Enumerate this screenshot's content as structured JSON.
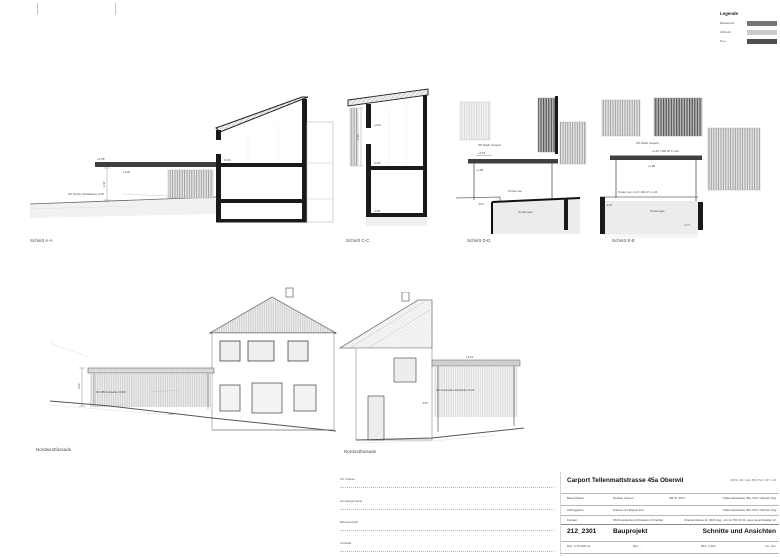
{
  "legend": {
    "title": "Legende",
    "items": [
      {
        "label": "Bestehend",
        "color": "#757575"
      },
      {
        "label": "Abbruch",
        "color": "#cbcbcb"
      },
      {
        "label": "Neu",
        "color": "#4f4f4f"
      }
    ]
  },
  "captions": {
    "schnitt_aa": "Schnitt A-A",
    "schnitt_cc": "Schnitt C-C",
    "schnitt_dd": "Schnitt D-D",
    "schnitt_ee": "Schnitt E-E",
    "nordwest": "Nordwestfassade",
    "nordost": "Nordostfassade"
  },
  "annotations": {
    "aa_lvl_top": "+2.35",
    "aa_lvl_under": "+2.20",
    "aa_dim": "2.37",
    "aa_terrain": "OK Terrain Verkleidung -0.02",
    "aa_zero": "±0.00",
    "cc_lvl1": "+2.69",
    "cc_zero": "±0.00",
    "cc_low": "-0.28",
    "cc_dim": "2.62",
    "dd_roof_label": "OK Dach Carport",
    "dd_lvl": "+2.15",
    "dd_under": "+1.98",
    "dd_terrain_neu": "Terrain neu",
    "dd_terrain_gew": "Terrain gew.",
    "dd_low": "-0.87",
    "ee_roof_label": "OK Dach Carport",
    "ee_lvl": "+2.15 / 492.35 m.ü.M.",
    "ee_under": "+1.96",
    "ee_terrain_neu": "Terrain neu -0.10 / 492.27 m.ü.M.",
    "ee_terrain_gew": "Terrain gew.",
    "ee_low1": "-0.22",
    "ee_low2": "-1.77",
    "nw_dim": "2.60",
    "nw_level": "OK FB Rohdecke ±0.00",
    "nw_low": "-0.87",
    "no_lvl": "+2.15",
    "no_level": "OK Fussboden Rohdecke ±0.00",
    "no_low": "-0.87"
  },
  "titleblock": {
    "project_title": "Carport Tellenmattstrasse 45a Oberwil",
    "parcel_info": "GB Nr. 404 / Geb. 636 / Parz. 427 / 4.M",
    "rows": [
      {
        "label": "Bauvorhaben",
        "value": "Neubau Carport",
        "extra": "GB Nr. 2971",
        "right": "Tellenmattstrasse 45a, 6317 Oberwil, Zug"
      },
      {
        "label": "Auftraggeber",
        "value": "Andrea und Raquel Frei",
        "extra": "",
        "right": "Tellenmattstrasse 45a, 6317 Oberwil, Zug"
      },
      {
        "label": "Kontakt",
        "value": "NM Kussbacher Architekten mb bachat",
        "extra": "",
        "right": "Chamerstrasse 11, 6300 Zug, +41 41 780 01 61, www.nk-architekten.ch"
      }
    ],
    "project_number": "212_2301",
    "phase": "Bauprojekt",
    "sheet_title": "Schnitte und Ansichten",
    "meta": {
      "date": "Dat.: 3.11.2021 lw",
      "rev": "Rev.: -",
      "scale": "Mst.: 1:100",
      "format": "Gr.: A2+"
    }
  },
  "signatures": {
    "items": [
      {
        "label": "Ort / Datum"
      },
      {
        "label": "Grundeigentümer"
      },
      {
        "label": "Bauherrschaft"
      },
      {
        "label": "Architekt"
      }
    ]
  }
}
